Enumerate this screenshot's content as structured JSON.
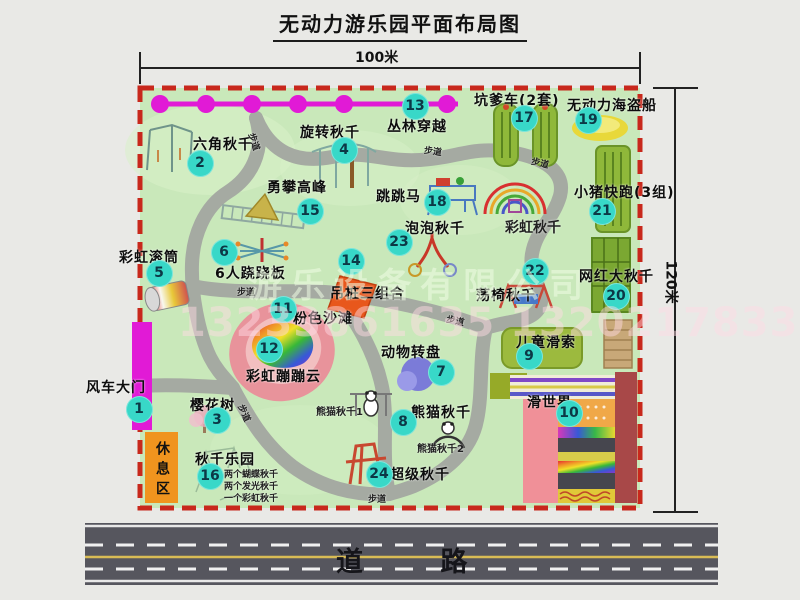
{
  "title": "无动力游乐园平面布局图",
  "dimensions": {
    "width": "100米",
    "height": "120米"
  },
  "road": {
    "label": "道 路"
  },
  "watermark": {
    "company": "游乐设备有限公司",
    "phone": "13233861635 13202178333"
  },
  "rest_area": {
    "label": "休息区"
  },
  "colors": {
    "park_green": "#c9e8ba",
    "boundary_red": "#c8281c",
    "path_gray": "#a5aaa2",
    "badge_teal": "#38d8c8",
    "gate_magenta": "#e11ad6",
    "rest_area_orange": "#f0941e",
    "road_gray": "#56565e",
    "road_center_yellow": "#d9bc55",
    "pink_beach": "#e8939b",
    "slide_pink": "#f09098",
    "slide_maroon": "#a84848"
  },
  "pois": [
    {
      "num": 1,
      "name": "风车大门",
      "badge": {
        "x": 139,
        "y": 409
      },
      "label": {
        "x": 86,
        "y": 377
      }
    },
    {
      "num": 2,
      "name": "六角秋千",
      "badge": {
        "x": 200,
        "y": 163
      },
      "label": {
        "x": 193,
        "y": 134
      }
    },
    {
      "num": 3,
      "name": "樱花树",
      "badge": {
        "x": 217,
        "y": 420
      },
      "label": {
        "x": 190,
        "y": 395
      }
    },
    {
      "num": 4,
      "name": "旋转秋千",
      "badge": {
        "x": 344,
        "y": 150
      },
      "label": {
        "x": 300,
        "y": 122
      }
    },
    {
      "num": 5,
      "name": "彩虹滚筒",
      "badge": {
        "x": 159,
        "y": 273
      },
      "label": {
        "x": 119,
        "y": 247
      }
    },
    {
      "num": 6,
      "name": "6人跷跷板",
      "badge": {
        "x": 224,
        "y": 252
      },
      "label": {
        "x": 215,
        "y": 263
      }
    },
    {
      "num": 7,
      "name": "动物转盘",
      "badge": {
        "x": 441,
        "y": 372
      },
      "label": {
        "x": 381,
        "y": 342
      }
    },
    {
      "num": 8,
      "name": "熊猫秋千",
      "badge": {
        "x": 403,
        "y": 422
      },
      "label": {
        "x": 411,
        "y": 402
      }
    },
    {
      "num": 9,
      "name": "儿童滑索",
      "badge": {
        "x": 529,
        "y": 356
      },
      "label": {
        "x": 516,
        "y": 332
      }
    },
    {
      "num": 10,
      "name": "滑世界",
      "badge": {
        "x": 569,
        "y": 413
      },
      "label": {
        "x": 527,
        "y": 392
      }
    },
    {
      "num": 11,
      "name": "粉色沙滩",
      "badge": {
        "x": 283,
        "y": 309
      },
      "label": {
        "x": 293,
        "y": 308
      }
    },
    {
      "num": 12,
      "name": "彩虹蹦蹦云",
      "badge": {
        "x": 269,
        "y": 349
      },
      "label": {
        "x": 246,
        "y": 366
      }
    },
    {
      "num": 13,
      "name": "丛林穿越",
      "badge": {
        "x": 415,
        "y": 106
      },
      "label": {
        "x": 387,
        "y": 116
      }
    },
    {
      "num": 14,
      "name": "吊桩三组合",
      "badge": {
        "x": 351,
        "y": 261
      },
      "label": {
        "x": 330,
        "y": 283
      }
    },
    {
      "num": 15,
      "name": "勇攀高峰",
      "badge": {
        "x": 310,
        "y": 211
      },
      "label": {
        "x": 267,
        "y": 177
      }
    },
    {
      "num": 16,
      "name": "秋千乐园",
      "badge": {
        "x": 210,
        "y": 476
      },
      "label": {
        "x": 195,
        "y": 449
      }
    },
    {
      "num": 17,
      "name": "坑爹车(2套)",
      "badge": {
        "x": 524,
        "y": 118
      },
      "label": {
        "x": 474,
        "y": 90
      }
    },
    {
      "num": 18,
      "name": "跳跳马",
      "badge": {
        "x": 437,
        "y": 202
      },
      "label": {
        "x": 376,
        "y": 186
      }
    },
    {
      "num": 19,
      "name": "无动力海盗船",
      "badge": {
        "x": 588,
        "y": 120
      },
      "label": {
        "x": 567,
        "y": 95
      }
    },
    {
      "num": 20,
      "name": "网红大秋千",
      "badge": {
        "x": 616,
        "y": 296
      },
      "label": {
        "x": 579,
        "y": 266
      }
    },
    {
      "num": 21,
      "name": "小猪快跑(3组)",
      "badge": {
        "x": 602,
        "y": 211
      },
      "label": {
        "x": 574,
        "y": 182
      }
    },
    {
      "num": 22,
      "name": "荡椅秋千",
      "badge": {
        "x": 535,
        "y": 271
      },
      "label": {
        "x": 476,
        "y": 285
      }
    },
    {
      "num": 23,
      "name": "泡泡秋千",
      "badge": {
        "x": 399,
        "y": 242
      },
      "label": {
        "x": 405,
        "y": 218
      }
    },
    {
      "num": 24,
      "name": "超级秋千",
      "badge": {
        "x": 379,
        "y": 474
      },
      "label": {
        "x": 390,
        "y": 464
      }
    }
  ],
  "extra_labels": [
    {
      "text": "彩虹秋千",
      "x": 505,
      "y": 217,
      "size": 14,
      "rot": 0
    },
    {
      "text": "熊猫秋千1",
      "x": 316,
      "y": 403,
      "size": 10,
      "rot": 0
    },
    {
      "text": "熊猫秋千2",
      "x": 417,
      "y": 440,
      "size": 10,
      "rot": 0
    },
    {
      "text": "两个蝴蝶秋千",
      "x": 224,
      "y": 467,
      "size": 9,
      "rot": 0
    },
    {
      "text": "两个发光秋千",
      "x": 224,
      "y": 479,
      "size": 9,
      "rot": 0
    },
    {
      "text": "一个彩虹秋千",
      "x": 224,
      "y": 491,
      "size": 9,
      "rot": 0
    },
    {
      "text": "步道",
      "x": 258,
      "y": 131,
      "size": 9,
      "rot": 72
    },
    {
      "text": "步道",
      "x": 425,
      "y": 143,
      "size": 9,
      "rot": 8
    },
    {
      "text": "步道",
      "x": 533,
      "y": 154,
      "size": 9,
      "rot": 14
    },
    {
      "text": "步道",
      "x": 237,
      "y": 285,
      "size": 9,
      "rot": 0
    },
    {
      "text": "步道",
      "x": 448,
      "y": 312,
      "size": 9,
      "rot": 12
    },
    {
      "text": "步道",
      "x": 247,
      "y": 402,
      "size": 9,
      "rot": 66
    },
    {
      "text": "步道",
      "x": 368,
      "y": 492,
      "size": 9,
      "rot": 0
    }
  ]
}
